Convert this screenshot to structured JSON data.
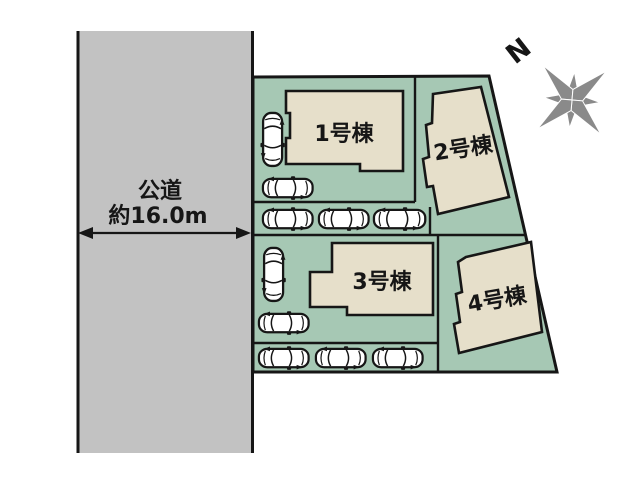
{
  "plan": {
    "road": {
      "name": "公道",
      "width": "約16.0m"
    },
    "compass": {
      "north_label": "N"
    },
    "buildings": [
      {
        "id": 1,
        "label": "1号棟"
      },
      {
        "id": 2,
        "label": "2号棟"
      },
      {
        "id": 3,
        "label": "3号棟"
      },
      {
        "id": 4,
        "label": "4号棟"
      }
    ],
    "parking": {
      "car_count": 10
    },
    "colors": {
      "road": "#c2c2c2",
      "lot_green": "#a6c8b4",
      "building_beige": "#e6dfca",
      "outline": "#161616",
      "compass_gray": "#8a8a8a",
      "car_body": "#ffffff",
      "background": "#ffffff"
    }
  }
}
